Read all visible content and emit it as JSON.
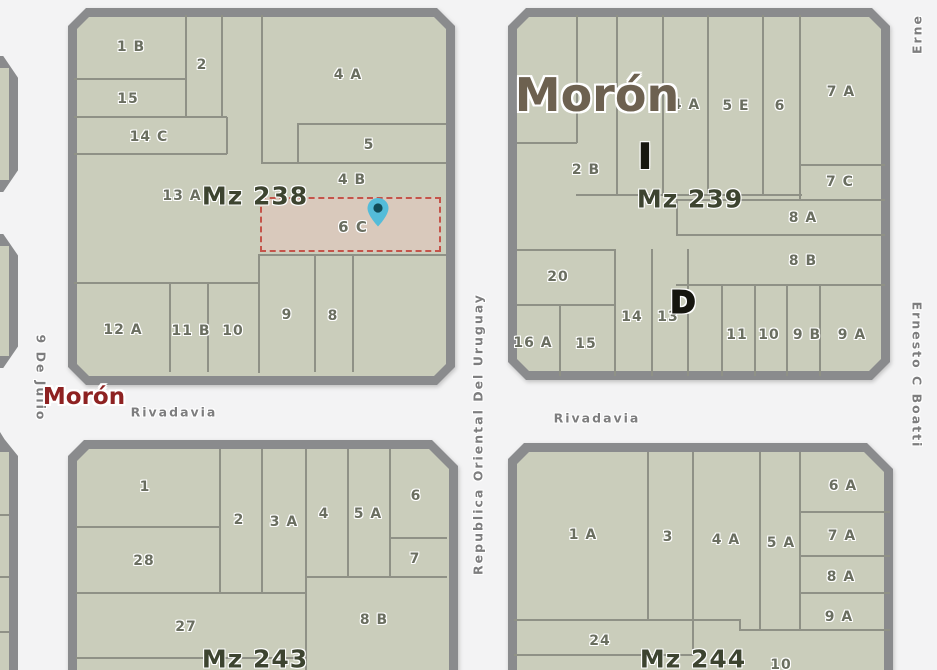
{
  "map": {
    "city_label_large": "Morón",
    "city_label_small_red": "Morón",
    "selected_parcel": {
      "label": "6 C",
      "block": "Mz 238"
    },
    "marker": {
      "icon": "map-pin",
      "color": "#54bcd9"
    },
    "streets": [
      {
        "name": "9 De Julio",
        "x": 41,
        "y": 378,
        "rot": 90
      },
      {
        "name": "Republica Oriental Del Uruguay",
        "x": 478,
        "y": 434,
        "rot": -90
      },
      {
        "name": "Ernesto C Boatti",
        "x": 917,
        "y": 375,
        "rot": 90
      },
      {
        "name": "Erne",
        "x": 917,
        "y": 34,
        "rot": -90,
        "partial": true
      },
      {
        "name": "Rivadavia",
        "x": 174,
        "y": 412,
        "rot": 0
      },
      {
        "name": "Rivadavia",
        "x": 597,
        "y": 418,
        "rot": 0
      }
    ],
    "blocks": [
      {
        "id": "mz238",
        "label": "Mz 238",
        "label_x": 255,
        "label_y": 196,
        "parcels": [
          {
            "t": "1 B",
            "x": 131,
            "y": 47
          },
          {
            "t": "2",
            "x": 202,
            "y": 65
          },
          {
            "t": "15",
            "x": 128,
            "y": 99
          },
          {
            "t": "14 C",
            "x": 149,
            "y": 137
          },
          {
            "t": "4 A",
            "x": 348,
            "y": 75
          },
          {
            "t": "5",
            "x": 369,
            "y": 145
          },
          {
            "t": "4 B",
            "x": 352,
            "y": 180
          },
          {
            "t": "13 A",
            "x": 182,
            "y": 196
          },
          {
            "t": "9",
            "x": 287,
            "y": 315
          },
          {
            "t": "8",
            "x": 333,
            "y": 316
          },
          {
            "t": "12 A",
            "x": 123,
            "y": 330
          },
          {
            "t": "11 B",
            "x": 191,
            "y": 331
          },
          {
            "t": "10",
            "x": 233,
            "y": 331
          }
        ],
        "letters": []
      },
      {
        "id": "mz239",
        "label": "Mz 239",
        "label_x": 690,
        "label_y": 199,
        "parcels": [
          {
            "t": "4 A",
            "x": 686,
            "y": 105
          },
          {
            "t": "5 E",
            "x": 736,
            "y": 106
          },
          {
            "t": "6",
            "x": 780,
            "y": 106
          },
          {
            "t": "7 A",
            "x": 841,
            "y": 92
          },
          {
            "t": "2 B",
            "x": 586,
            "y": 170
          },
          {
            "t": "7 C",
            "x": 840,
            "y": 182
          },
          {
            "t": "8 A",
            "x": 803,
            "y": 218
          },
          {
            "t": "8 B",
            "x": 803,
            "y": 261
          },
          {
            "t": "20",
            "x": 558,
            "y": 277
          },
          {
            "t": "14",
            "x": 632,
            "y": 317
          },
          {
            "t": "13",
            "x": 668,
            "y": 317
          },
          {
            "t": "11",
            "x": 737,
            "y": 335
          },
          {
            "t": "10",
            "x": 769,
            "y": 335
          },
          {
            "t": "9 B",
            "x": 807,
            "y": 335
          },
          {
            "t": "9 A",
            "x": 852,
            "y": 335
          },
          {
            "t": "16 A",
            "x": 533,
            "y": 343
          },
          {
            "t": "15",
            "x": 586,
            "y": 344
          }
        ],
        "letters": [
          {
            "t": "I",
            "x": 645,
            "y": 157,
            "size": 34
          },
          {
            "t": "D",
            "x": 683,
            "y": 303,
            "size": 30
          }
        ]
      },
      {
        "id": "mz243",
        "label": "Mz 243",
        "label_x": 255,
        "label_y": 659,
        "parcels": [
          {
            "t": "1",
            "x": 145,
            "y": 487
          },
          {
            "t": "2",
            "x": 239,
            "y": 520
          },
          {
            "t": "3 A",
            "x": 284,
            "y": 522
          },
          {
            "t": "4",
            "x": 324,
            "y": 514
          },
          {
            "t": "5 A",
            "x": 368,
            "y": 514
          },
          {
            "t": "6",
            "x": 416,
            "y": 496
          },
          {
            "t": "7",
            "x": 415,
            "y": 559
          },
          {
            "t": "28",
            "x": 144,
            "y": 561
          },
          {
            "t": "27",
            "x": 186,
            "y": 627
          },
          {
            "t": "8 B",
            "x": 374,
            "y": 620
          }
        ],
        "letters": []
      },
      {
        "id": "mz244",
        "label": "Mz 244",
        "label_x": 693,
        "label_y": 659,
        "parcels": [
          {
            "t": "1 A",
            "x": 583,
            "y": 535
          },
          {
            "t": "3",
            "x": 668,
            "y": 537
          },
          {
            "t": "4 A",
            "x": 726,
            "y": 540
          },
          {
            "t": "5 A",
            "x": 781,
            "y": 543
          },
          {
            "t": "6 A",
            "x": 843,
            "y": 486
          },
          {
            "t": "7 A",
            "x": 842,
            "y": 536
          },
          {
            "t": "8 A",
            "x": 841,
            "y": 577
          },
          {
            "t": "9 A",
            "x": 839,
            "y": 617
          },
          {
            "t": "24",
            "x": 600,
            "y": 641
          },
          {
            "t": "10",
            "x": 781,
            "y": 665
          }
        ],
        "letters": []
      }
    ],
    "colors": {
      "street_bg": "#f3f3f4",
      "block_border": "#8a8b8d",
      "parcel_fill": "#cacdbb",
      "parcel_line": "#8f9186",
      "parcel_label": "#6a6e60",
      "block_label": "#3d4430",
      "city_large": "#6d6150",
      "city_red": "#8e2222",
      "street_label": "#7d7d7e",
      "marker_teal": "#54bcd9",
      "selection_red": "#c4544a",
      "selection_fill": "#d9c9bc"
    }
  }
}
